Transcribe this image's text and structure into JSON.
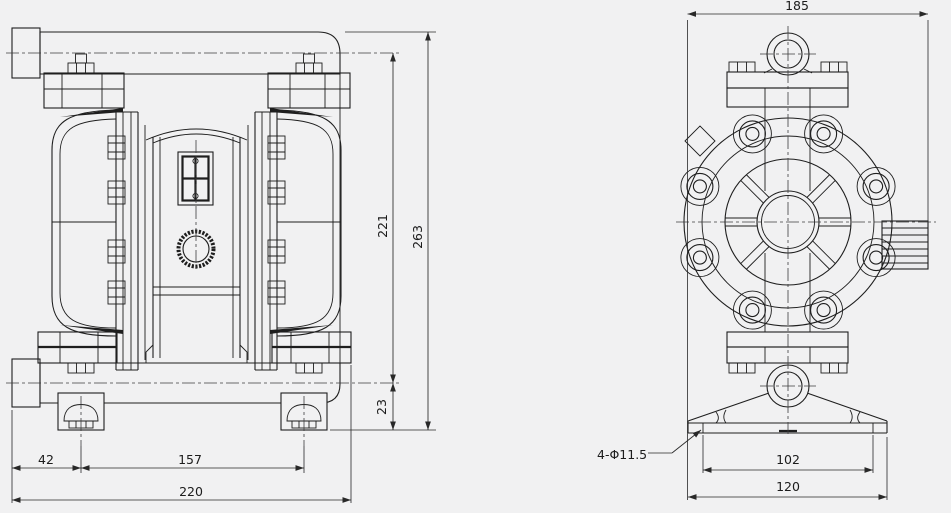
{
  "front_view": {
    "dims": {
      "foot_offset": "42",
      "foot_span": "157",
      "overall_width": "220",
      "port_center_height": "221",
      "overall_height": "263",
      "foot_height": "23"
    }
  },
  "side_view": {
    "dims": {
      "overall_width": "185",
      "base_hole_span": "102",
      "base_width": "120",
      "base_holes": "4-Φ11.5"
    }
  },
  "colors": {
    "background": "#f1f1f2",
    "line": "#1e1e1e",
    "dimension": "#282828"
  }
}
